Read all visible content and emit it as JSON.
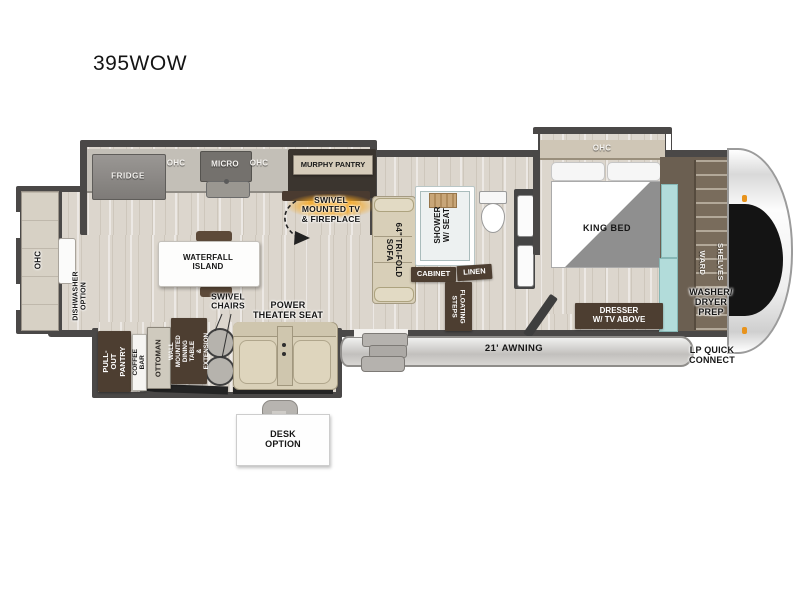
{
  "title": "395WOW",
  "colors": {
    "wall": "#4a4847",
    "floor": "#dcd6cd",
    "label_brown": "#4d3e31",
    "accent_orange": "#f2a71e",
    "teal_accent": "#aed9d8",
    "awning_gray": "#c7c5c2"
  },
  "labels": {
    "ohc_rear": "OHC",
    "dishwasher_option": "DISHWASHER\nOPTION",
    "fridge": "FRIDGE",
    "ohc_kitchen_left": "OHC",
    "micro": "MICRO",
    "ohc_kitchen_right": "OHC",
    "murphy_pantry": "MURPHY PANTRY",
    "swivel_tv": "SWIVEL\nMOUNTED TV\n& FIREPLACE",
    "waterfall_island": "WATERFALL\nISLAND",
    "sofa": "64\" TRI-FOLD\nSOFA",
    "shower": "SHOWER\nW/ SEAT",
    "cabinet": "CABINET",
    "linen": "LINEN",
    "floating_steps": "FLOATING\nSTEPS",
    "ohc_bedroom": "OHC",
    "king_bed": "KING BED",
    "dresser": "DRESSER\nW/ TV ABOVE",
    "ward": "WARD",
    "shelves": "SHELVES",
    "washer_dryer_prep": "WASHER/\nDRYER\nPREP",
    "lp_quick_connect": "LP QUICK\nCONNECT",
    "awning": "21' AWNING",
    "swivel_chairs": "SWIVEL\nCHAIRS",
    "power_theater_seat": "POWER\nTHEATER SEAT",
    "pull_out_pantry": "PULL-OUT\nPANTRY",
    "coffee_bar": "COFFEE BAR",
    "ottoman": "OTTOMAN",
    "dining_table": "WALL MOUNTED\nDINING TABLE\n& EXTENSION",
    "desk_option": "DESK\nOPTION"
  }
}
